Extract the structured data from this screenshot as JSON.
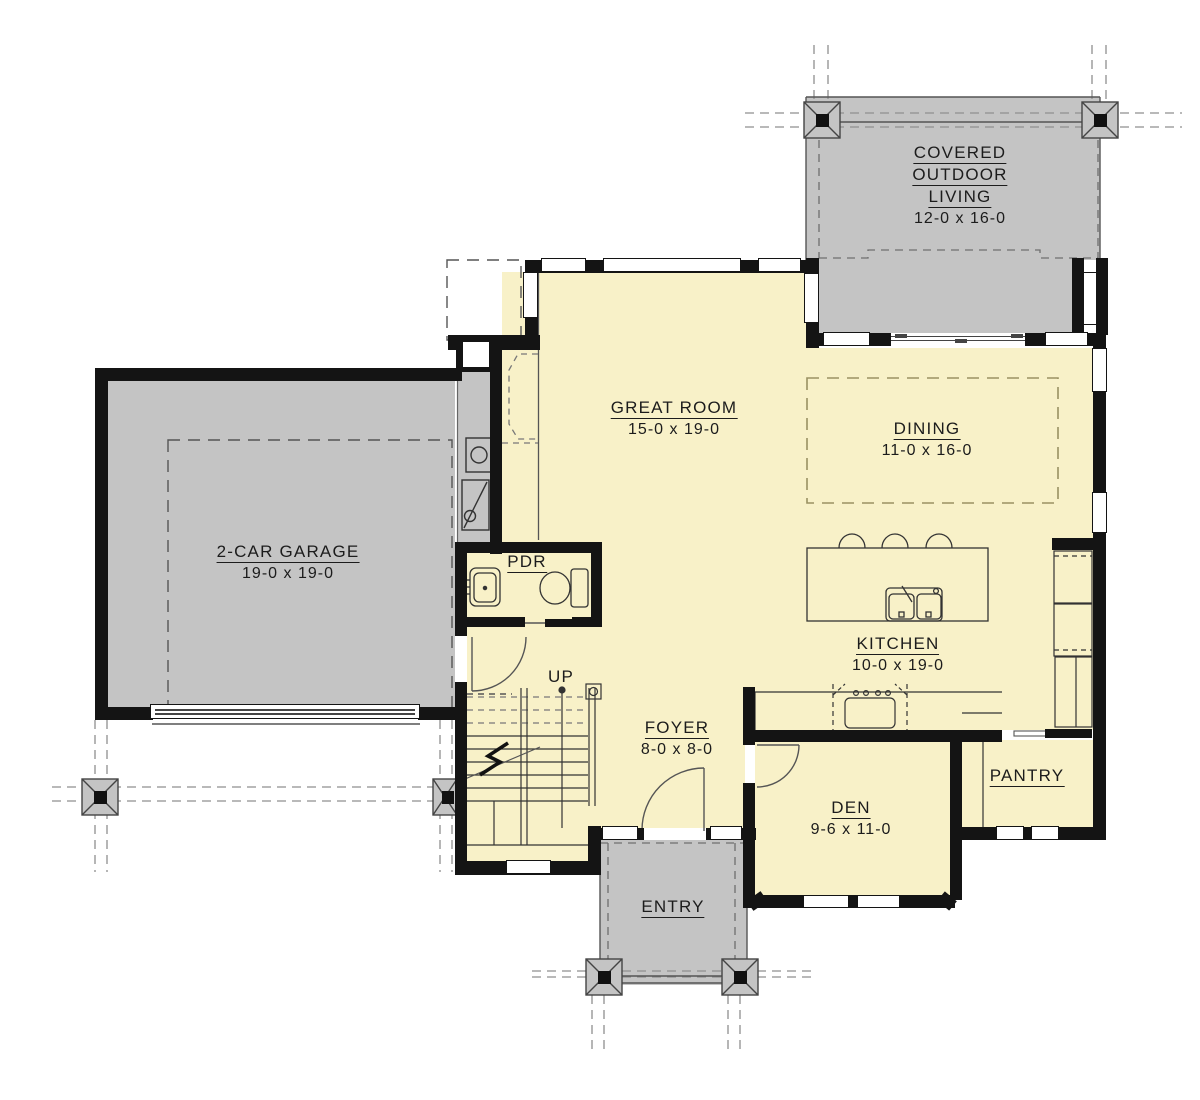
{
  "plan": {
    "rooms": {
      "covered_outdoor_living": {
        "name_lines": [
          "COVERED",
          "OUTDOOR",
          "LIVING"
        ],
        "dims": "12-0 x 16-0"
      },
      "great_room": {
        "name": "GREAT ROOM",
        "dims": "15-0 x 19-0"
      },
      "dining": {
        "name": "DINING",
        "dims": "11-0 x 16-0"
      },
      "garage": {
        "name": "2-CAR GARAGE",
        "dims": "19-0 x 19-0"
      },
      "powder": {
        "name": "PDR"
      },
      "kitchen": {
        "name": "KITCHEN",
        "dims": "10-0 x 19-0"
      },
      "foyer": {
        "name": "FOYER",
        "dims": "8-0 x 8-0"
      },
      "den": {
        "name": "DEN",
        "dims": "9-6 x 11-0"
      },
      "pantry": {
        "name": "PANTRY"
      },
      "entry": {
        "name": "ENTRY"
      }
    },
    "stairs": {
      "label": "UP"
    },
    "colors": {
      "floor": "#F8F1C8",
      "porch_gray": "#C4C4C4",
      "wall": "#141414",
      "dining_dash": "#9A9162"
    }
  }
}
